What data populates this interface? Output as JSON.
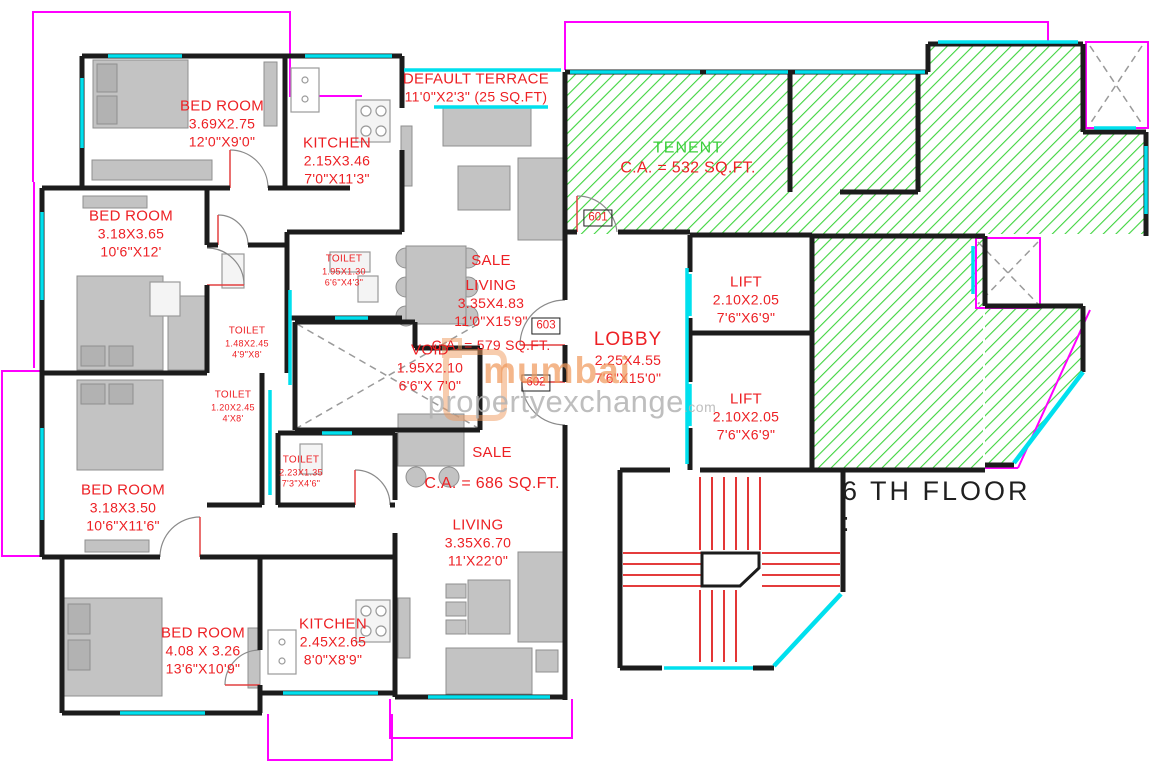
{
  "floor_title": "6 TH FLOOR :",
  "watermark": {
    "brand_top": "mumbai",
    "brand_bottom": "propertyexchange",
    "brand_tld": ".com"
  },
  "unit_numbers": {
    "unit_top": "601",
    "unit_mid": "603",
    "unit_low": "602"
  },
  "labels": {
    "bedroom_top_left": {
      "name": "BED ROOM",
      "dim_m": "3.69X2.75",
      "dim_ft": "12'0\"X9'0\""
    },
    "kitchen_top": {
      "name": "KITCHEN",
      "dim_m": "2.15X3.46",
      "dim_ft": "7'0\"X11'3\""
    },
    "terrace": {
      "name": "DEFAULT TERRACE",
      "size": "11'0\"X2'3\" (25 SQ.FT)"
    },
    "tenant": {
      "name": "TENENT",
      "area": "C.A. = 532 SQ.FT."
    },
    "bedroom_mid_left": {
      "name": "BED ROOM",
      "dim_m": "3.18X3.65",
      "dim_ft": "10'6\"X12'"
    },
    "toilet_top": {
      "name": "TOILET",
      "dim_m": "1.95X1.30",
      "dim_ft": "6'6\"X4'3\""
    },
    "toilet_mid": {
      "name": "TOILET",
      "dim_m": "1.48X2.45",
      "dim_ft": "4'9\"X8'"
    },
    "toilet_low": {
      "name": "TOILET",
      "dim_m": "1.20X2.45",
      "dim_ft": "4'X8'"
    },
    "void_shaft": {
      "name": "VOID",
      "dim_m": "1.95X2.10",
      "dim_ft": "6'6\"X 7'0\""
    },
    "sale_living": {
      "unit_type": "SALE",
      "room": "LIVING",
      "dim_m": "3.35X4.83",
      "dim_ft": "11'0\"X15'9\"",
      "area": "C.A. = 579 SQ.FT."
    },
    "lobby": {
      "name": "LOBBY",
      "dim_m": "2.25X4.55",
      "dim_ft": "7'6\"X15'0\""
    },
    "lift_upper": {
      "name": "LIFT",
      "dim_m": "2.10X2.05",
      "dim_ft": "7'6\"X6'9\""
    },
    "lift_lower": {
      "name": "LIFT",
      "dim_m": "2.10X2.05",
      "dim_ft": "7'6\"X6'9\""
    },
    "toilet_attached": {
      "name": "TOILET",
      "dim_m": "2.23X1.35",
      "dim_ft": "7'3\"X4'6\""
    },
    "sale_lower": {
      "unit_type": "SALE",
      "area": "C.A. = 686 SQ.FT."
    },
    "bedroom_lower_left": {
      "name": "BED ROOM",
      "dim_m": "3.18X3.50",
      "dim_ft": "10'6\"X11'6\""
    },
    "living_lower": {
      "name": "LIVING",
      "dim_m": "3.35X6.70",
      "dim_ft": "11'X22'0\""
    },
    "bedroom_bottom": {
      "name": "BED ROOM",
      "dim_m": "4.08 X 3.26",
      "dim_ft": "13'6\"X10'9\""
    },
    "kitchen_bottom": {
      "name": "KITCHEN",
      "dim_m": "2.45X2.65",
      "dim_ft": "8'0\"X8'9\""
    }
  },
  "colors": {
    "wall_black": "#1c1c1c",
    "window_cyan": "#00e0ee",
    "boundary_magenta": "#ff00ff",
    "label_red": "#ed2024",
    "hatch_green": "#3fd43f",
    "tenant_text_green": "#3ccf3c",
    "stair_red": "#e02020",
    "furniture_gray": "#c3c3c3",
    "watermark_orange": "#f09a5e",
    "watermark_gray": "#b3b3b3"
  }
}
